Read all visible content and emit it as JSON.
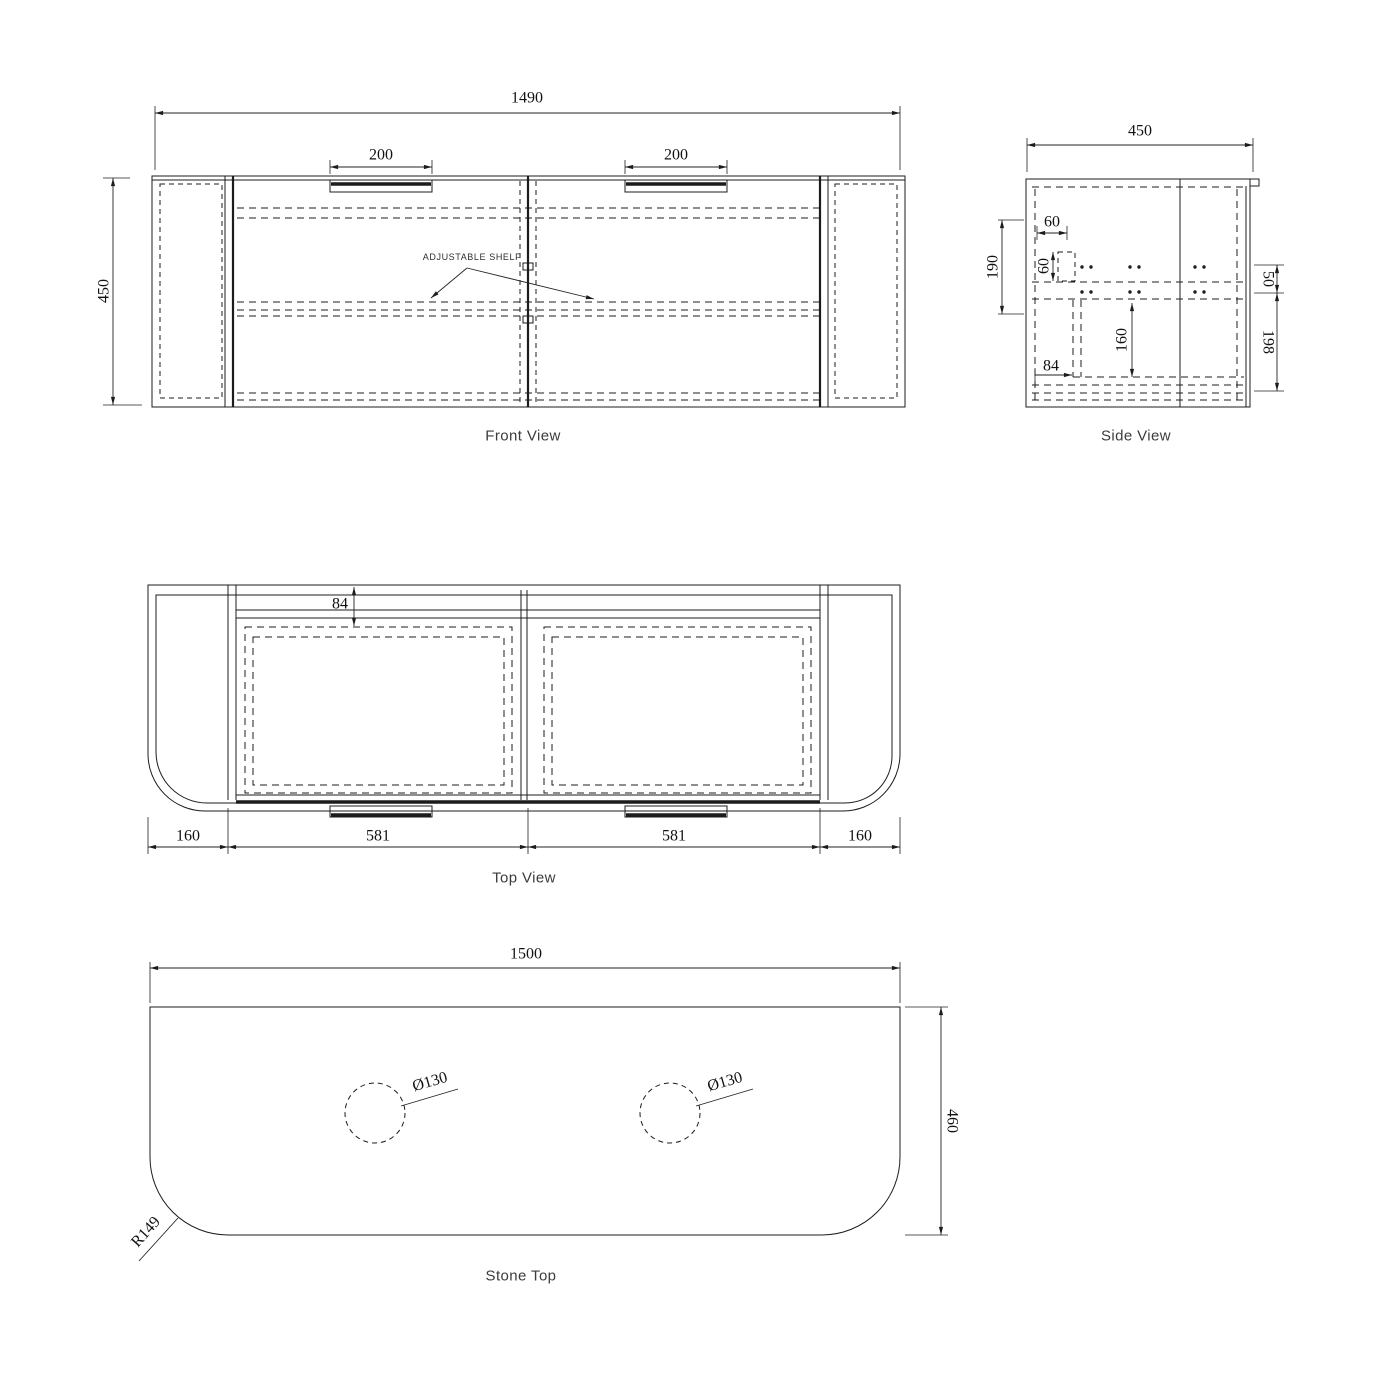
{
  "drawing": {
    "views": {
      "front": {
        "caption": "Front View",
        "note": "ADJUSTABLE SHELF",
        "dims": {
          "overall_width": "1490",
          "overall_height": "450",
          "handle_left": "200",
          "handle_right": "200"
        }
      },
      "side": {
        "caption": "Side View",
        "dims": {
          "overall_depth": "450",
          "back_offset": "190",
          "rail_width": "60",
          "rail_height": "60",
          "drawer_depth": "160",
          "bottom_inset": "84",
          "top_gap": "50",
          "lower_gap": "198"
        }
      },
      "top": {
        "caption": "Top View",
        "dims": {
          "front_inset": "84",
          "left_offset": "160",
          "door_left": "581",
          "door_right": "581",
          "right_offset": "160"
        }
      },
      "stone": {
        "caption": "Stone Top",
        "dims": {
          "width": "1500",
          "depth": "460",
          "hole_left": "Ø130",
          "hole_right": "Ø130",
          "corner_radius": "R149"
        }
      }
    }
  }
}
